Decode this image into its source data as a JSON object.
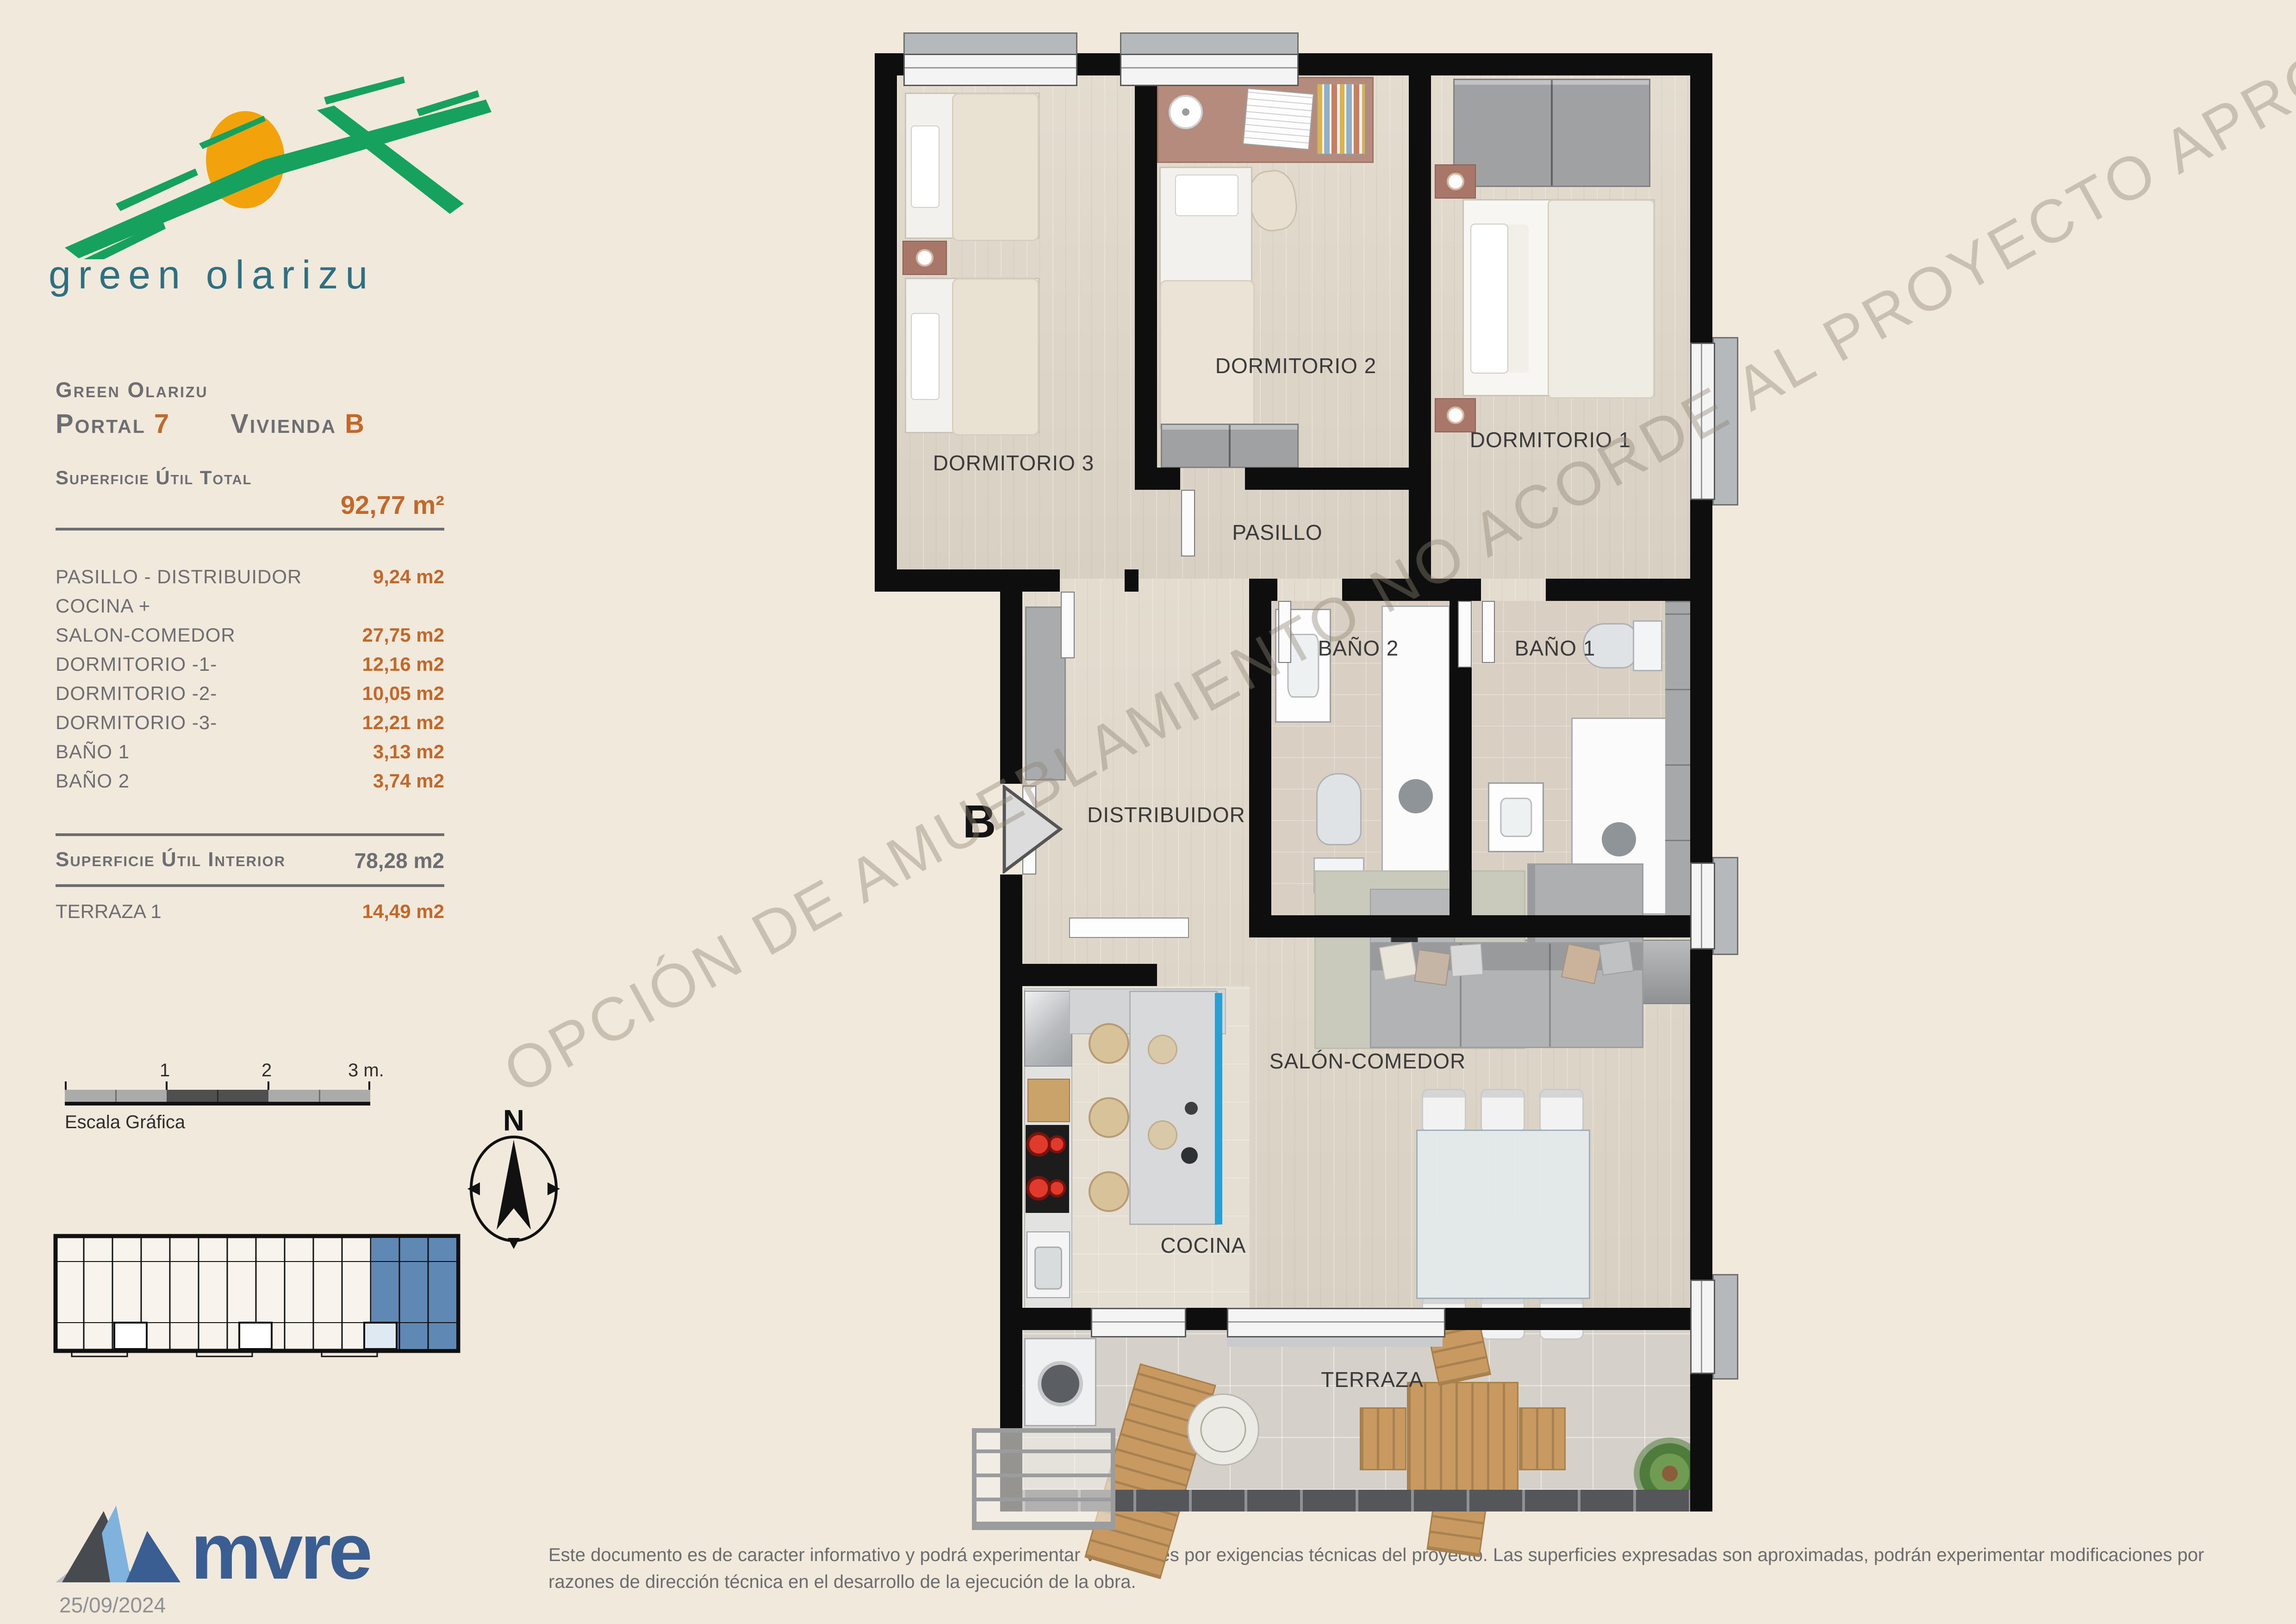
{
  "brand": {
    "logo_text": "green olarizu"
  },
  "sidebar": {
    "project": "Green Olarizu",
    "portal": {
      "label": "Portal",
      "number": "7"
    },
    "vivienda": {
      "label": "Vivienda",
      "letter": "B"
    },
    "total": {
      "label": "Superficie Útil Total",
      "value": "92,77 m²"
    },
    "rooms": [
      {
        "label": "PASILLO - DISTRIBUIDOR",
        "value": "9,24 m2"
      },
      {
        "label": "COCINA +",
        "value": ""
      },
      {
        "label": "SALON-COMEDOR",
        "value": "27,75 m2"
      },
      {
        "label": "DORMITORIO -1-",
        "value": "12,16 m2"
      },
      {
        "label": "DORMITORIO -2-",
        "value": "10,05 m2"
      },
      {
        "label": "DORMITORIO -3-",
        "value": "12,21 m2"
      },
      {
        "label": "BAÑO 1",
        "value": "3,13 m2"
      },
      {
        "label": "BAÑO 2",
        "value": "3,74 m2"
      }
    ],
    "interior": {
      "label": "Superficie Útil Interior",
      "value": "78,28 m2"
    },
    "terraza": {
      "label": "TERRAZA 1",
      "value": "14,49 m2"
    }
  },
  "scalebar": {
    "ticks": [
      "1",
      "2",
      "3 m."
    ],
    "caption": "Escala Gráfica"
  },
  "compass": {
    "north": "N"
  },
  "plan": {
    "watermark": "OPCIÓN DE AMUEBLAMIENTO NO ACORDE AL PROYECTO APROBADO",
    "entrance": "B",
    "rooms": {
      "dorm3": "DORMITORIO 3",
      "dorm2": "DORMITORIO 2",
      "dorm1": "DORMITORIO 1",
      "pasillo": "PASILLO",
      "bano2": "BAÑO 2",
      "bano1": "BAÑO 1",
      "distribuidor": "DISTRIBUIDOR",
      "salon": "SALÓN-COMEDOR",
      "cocina": "COCINA",
      "terraza": "TERRAZA"
    }
  },
  "footer": {
    "brand": "mvre",
    "date": "25/09/2024",
    "disclaimer": "Este documento es de caracter informativo y podrá experimentar variaciones por exigencias técnicas del proyecto. Las superficies expresadas son aproximadas, podrán experimentar modificaciones por razones de dirección técnica en el desarrollo de la ejecución de la obra."
  },
  "colors": {
    "accent_orange": "#c2682a",
    "text_gray": "#6d6e71",
    "unit_highlight_blue": "#5f88b4",
    "island_blue": "#2a9fd4",
    "background": "#f2e9dd"
  }
}
